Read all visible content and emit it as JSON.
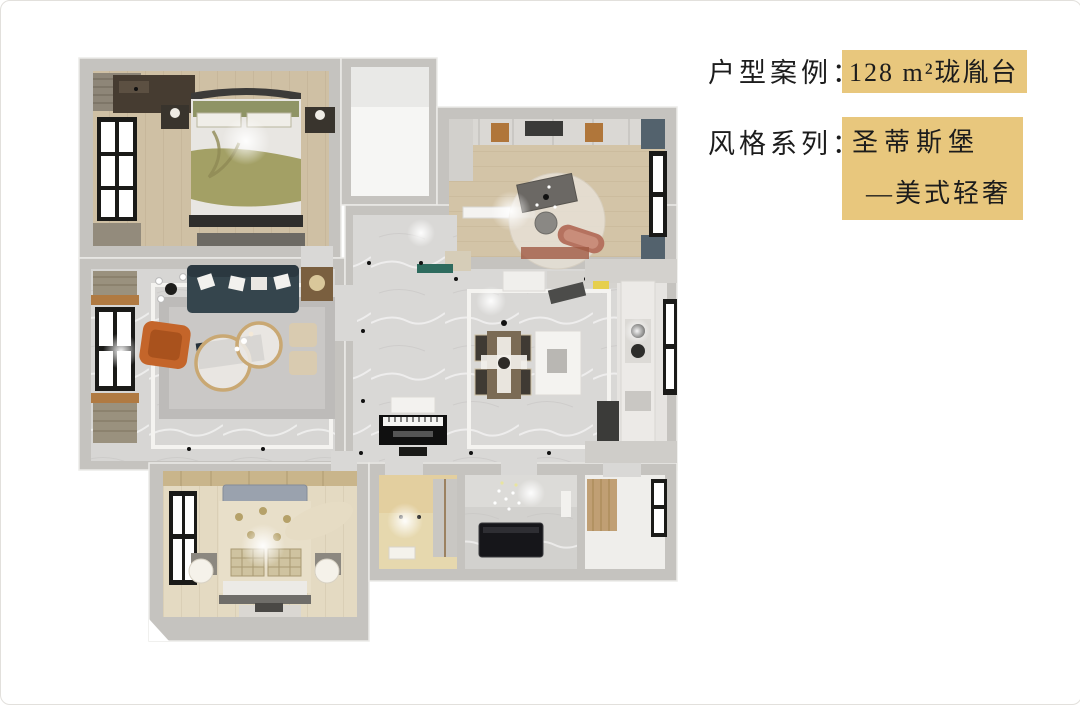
{
  "header": {
    "case_label": "户型案例：",
    "case_value": "128 m²珑胤台",
    "style_label": "风格系列：",
    "style_value_line1": "圣蒂斯堡",
    "style_value_line2": "—美式轻奢"
  },
  "colors": {
    "highlight": "#e8c77d",
    "text": "#1c1c1c",
    "wall": "#c5c3bf",
    "wood_floor": "#cfc0a4",
    "marble_floor": "#d9d8d6",
    "sofa_teal": "#35454d",
    "armchair_orange": "#c4652a",
    "bed_olive": "#a3a065",
    "window_frame": "#1a1a18"
  },
  "floorplan": {
    "kind": "3d-top-down-render",
    "rooms": [
      "master-bedroom",
      "utility-room",
      "study-bedroom",
      "living-room",
      "hallway",
      "dining-area",
      "kitchen",
      "second-bedroom",
      "closet-room",
      "bathroom",
      "balcony"
    ]
  }
}
